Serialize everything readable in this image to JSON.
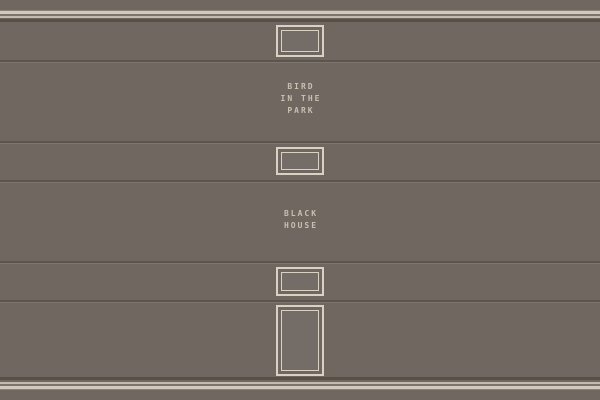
{
  "wall": {
    "titles": {
      "bird": {
        "line1": "BIRD",
        "line2": "IN THE",
        "line3": "PARK"
      },
      "black": {
        "line1": "BLACK",
        "line2": "HOUSE"
      }
    },
    "colors": {
      "base": "#6f6760",
      "trim_cream": "#d2cabd",
      "trim_cream_thin": "#c3bbaf",
      "trim_light": "#8a827a",
      "trim_mid": "#7b736c",
      "trim_dark": "#575049",
      "groove_dark": "#5c554e",
      "groove_light": "#7d756e",
      "frame_border": "#d8d1c4",
      "frame_fill": "#746c66",
      "text": "#c8c0b3"
    }
  }
}
